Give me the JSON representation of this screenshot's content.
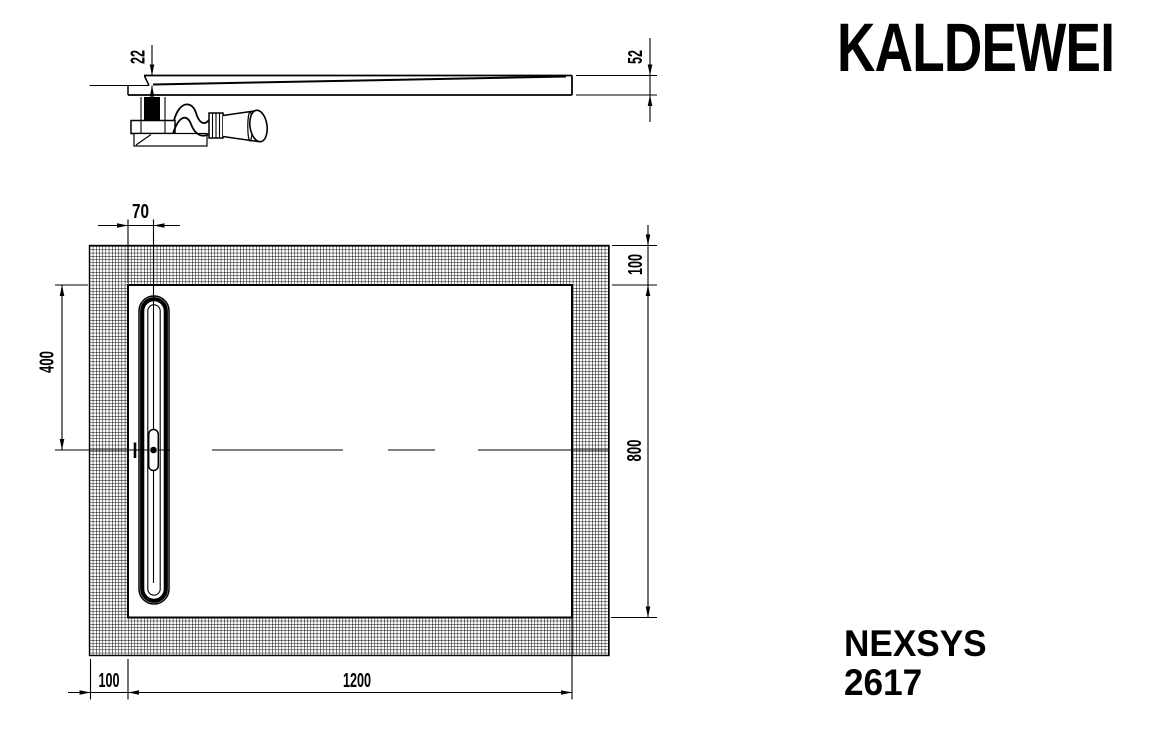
{
  "brand": {
    "logo_text": "KALDEWEI"
  },
  "product": {
    "series": "NEXSYS",
    "model": "2617"
  },
  "side_view": {
    "depth_to_drain_mm": "22",
    "edge_height_mm": "52"
  },
  "plan_view": {
    "drain_offset_from_edge_mm": "70",
    "drain_center_from_top_mm": "400",
    "surround_top_mm": "100",
    "tray_width_mm": "800",
    "surround_left_mm": "100",
    "tray_length_mm": "1200"
  },
  "colors": {
    "line": "#000000",
    "background": "#ffffff"
  }
}
